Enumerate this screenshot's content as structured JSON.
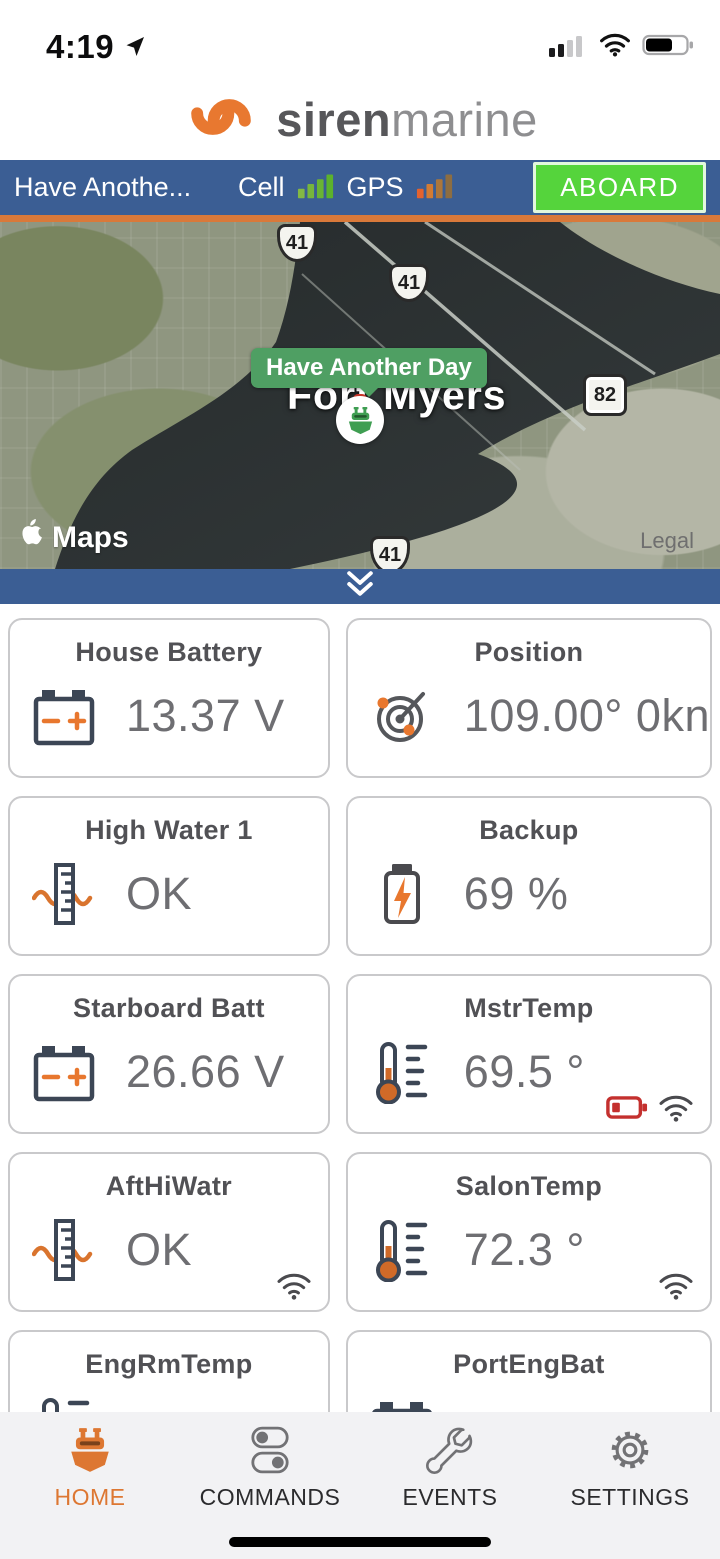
{
  "status_bar": {
    "time": "4:19"
  },
  "header": {
    "brand_bold": "siren",
    "brand_light": "marine"
  },
  "device_bar": {
    "device_name": "Have Anothe...",
    "cell_label": "Cell",
    "gps_label": "GPS",
    "aboard_label": "ABOARD"
  },
  "map": {
    "tooltip": "Have Another Day",
    "city_label": "Fort Myers",
    "maps_logo": "Maps",
    "legal_label": "Legal",
    "route_shields": [
      "41",
      "41",
      "41",
      "82"
    ]
  },
  "sensors": [
    {
      "name": "House Battery",
      "value": "13.37 V",
      "icon": "battery",
      "badges": []
    },
    {
      "name": "Position",
      "value": "109.00° 0kn",
      "icon": "gps",
      "badges": []
    },
    {
      "name": "High Water 1",
      "value": "OK",
      "icon": "water-level",
      "badges": []
    },
    {
      "name": "Backup",
      "value": "69 %",
      "icon": "backup",
      "badges": []
    },
    {
      "name": "Starboard Batt",
      "value": "26.66 V",
      "icon": "battery",
      "badges": []
    },
    {
      "name": "MstrTemp",
      "value": "69.5 °",
      "icon": "thermometer",
      "badges": [
        "low-battery",
        "wireless"
      ]
    },
    {
      "name": "AftHiWatr",
      "value": "OK",
      "icon": "water-level",
      "badges": [
        "wireless"
      ]
    },
    {
      "name": "SalonTemp",
      "value": "72.3 °",
      "icon": "thermometer",
      "badges": [
        "wireless"
      ]
    },
    {
      "name": "EngRmTemp",
      "value": "",
      "icon": "thermometer",
      "badges": []
    },
    {
      "name": "PortEngBat",
      "value": "",
      "icon": "battery",
      "badges": []
    }
  ],
  "nav": [
    {
      "label": "HOME",
      "icon": "boat",
      "active": true
    },
    {
      "label": "COMMANDS",
      "icon": "toggles",
      "active": false
    },
    {
      "label": "EVENTS",
      "icon": "wrench",
      "active": false
    },
    {
      "label": "SETTINGS",
      "icon": "gear",
      "active": false
    }
  ],
  "colors": {
    "header_blue": "#3b5e94",
    "divider_orange": "#d9793a",
    "aboard_green": "#55d43c",
    "brand_orange": "#e87830",
    "active_orange": "#dd7732",
    "icon_slate": "#3c4655",
    "icon_orange": "#e8772e",
    "alert_red": "#c4302e"
  }
}
